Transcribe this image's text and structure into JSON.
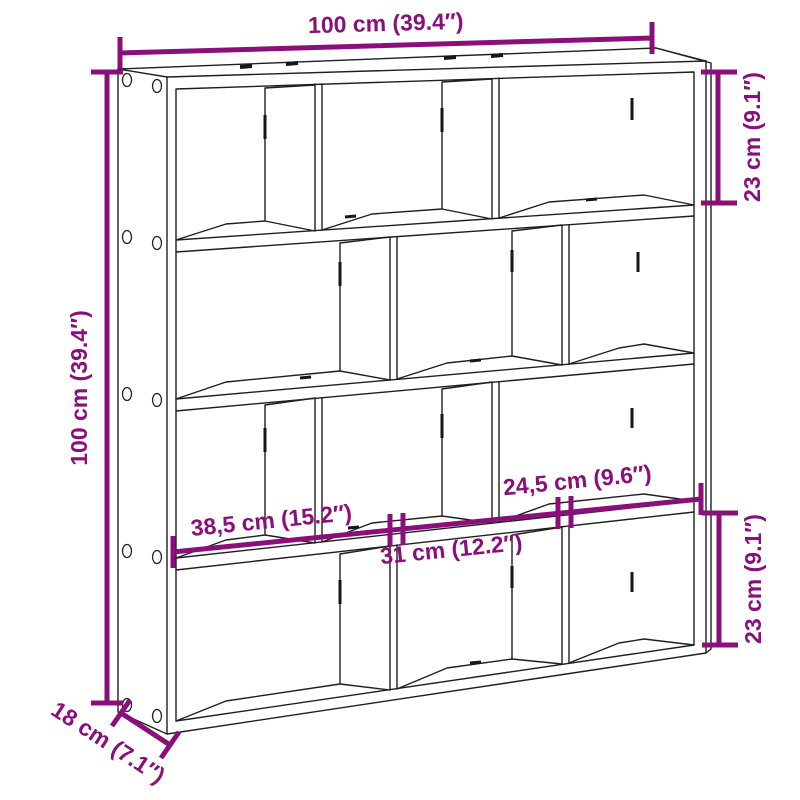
{
  "colors": {
    "accent": "#8A0F7A",
    "line": "#1f1f1f",
    "background": "#ffffff"
  },
  "diagram": {
    "kind": "furniture dimension drawing",
    "unit_counts": {
      "rows": 4,
      "compartments": 12
    }
  },
  "dimensions": {
    "top_width": "100 cm (39.4″)",
    "left_height": "100 cm (39.4″)",
    "right_top_compartment_height": "23 cm (9.1″)",
    "right_bottom_compartment_height": "23 cm (9.1″)",
    "compartment_width_large": "38,5 cm (15.2″)",
    "compartment_width_medium": "31 cm (12.2″)",
    "compartment_width_small": "24,5 cm (9.6″)",
    "depth": "18 cm (7.1″)"
  }
}
